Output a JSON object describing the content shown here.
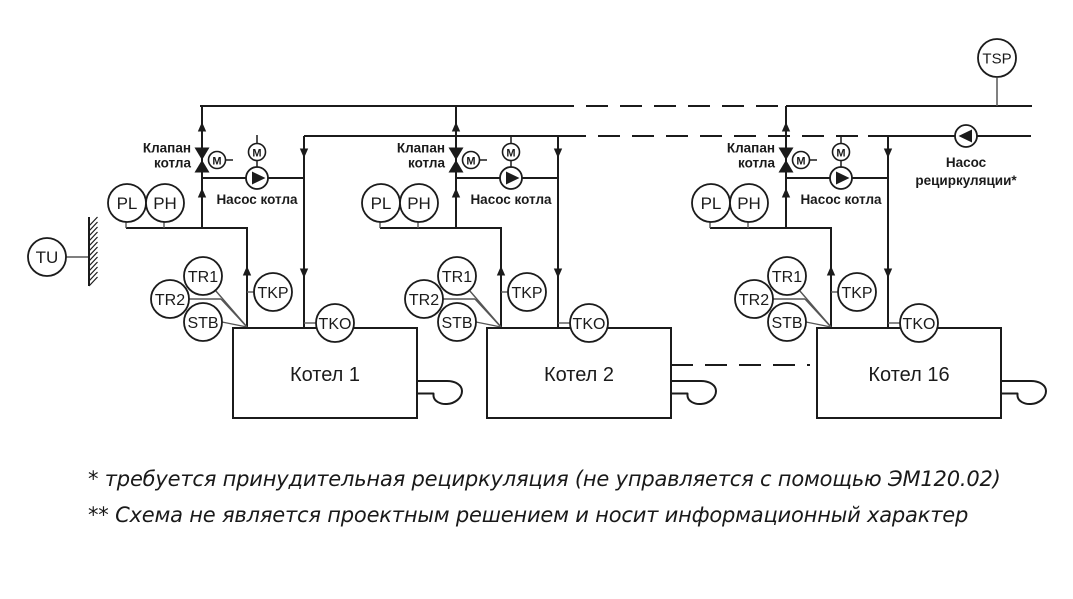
{
  "diagram": {
    "background": "#ffffff",
    "line_color": "#1b1b1b",
    "sensor_tap_color": "#555555",
    "units": [
      {
        "name": "Котел 1",
        "dx": 0
      },
      {
        "name": "Котел 2",
        "dx": 254
      },
      {
        "name": "Котел 16",
        "dx": 584
      }
    ],
    "sensors": {
      "tu": "TU",
      "tsp": "TSP",
      "pl": "PL",
      "ph": "PH",
      "tr1": "TR1",
      "tr2": "TR2",
      "stb": "STB",
      "tkp": "TKP",
      "tko": "TKO",
      "motor": "M"
    },
    "labels": {
      "valve_line1": "Клапан",
      "valve_line2": "котла",
      "boiler_pump": "Насос котла",
      "recirc_line1": "Насос",
      "recirc_line2": "рециркуляции*"
    },
    "footnotes": [
      "* требуется принудительная рециркуляция (не управляется с помощью ЭМ120.02)",
      "** Схема не является проектным решением и носит информационный характер"
    ]
  }
}
